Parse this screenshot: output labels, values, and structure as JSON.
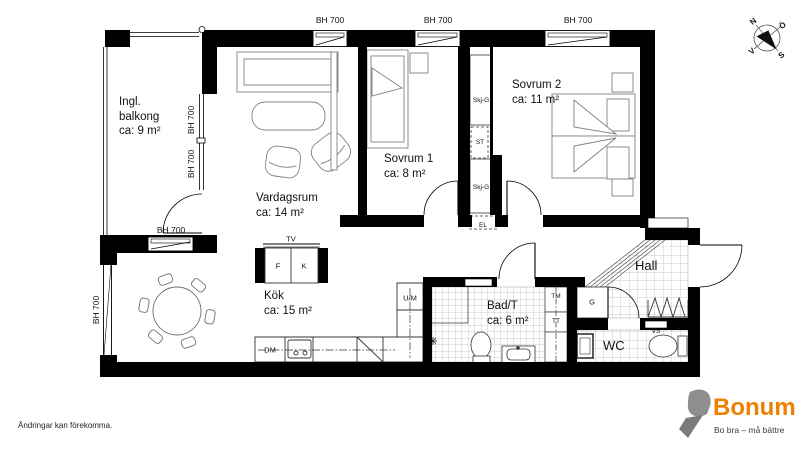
{
  "plan": {
    "window_label": "BH 700",
    "rooms": {
      "balcony": {
        "name": "Ingl. balkong",
        "area": "ca: 9 m²"
      },
      "livingroom": {
        "name": "Vardagsrum",
        "area": "ca: 14 m²"
      },
      "bedroom1": {
        "name": "Sovrum 1",
        "area": "ca: 8 m²"
      },
      "bedroom2": {
        "name": "Sovrum 2",
        "area": "ca: 11 m²"
      },
      "kitchen": {
        "name": "Kök",
        "area": "ca: 15 m²"
      },
      "bathroom": {
        "name": "Bad/T",
        "area": "ca: 6 m²"
      },
      "wc": {
        "name": "WC"
      },
      "hall": {
        "name": "Hall"
      }
    },
    "fixtures": {
      "tv": "TV",
      "fridge": "F",
      "freezer": "K",
      "dishwasher": "DM",
      "oven_micro": "U/M",
      "washer": "TM",
      "dryer": "TT",
      "wardrobe": "G",
      "sliding_wardrobe": "Skj-G",
      "cleaning": "ST",
      "electrical": "EL",
      "water": "VS"
    }
  },
  "compass": {
    "north": "N",
    "east": "Ö",
    "south": "S",
    "west": "V"
  },
  "branding": {
    "logo_text": "Bonum",
    "tagline": "Bo bra – må bättre",
    "orange": "#EE7F00",
    "gray": "#8E8E8E"
  },
  "footer": {
    "disclaimer": "Ändringar kan förekomma."
  }
}
